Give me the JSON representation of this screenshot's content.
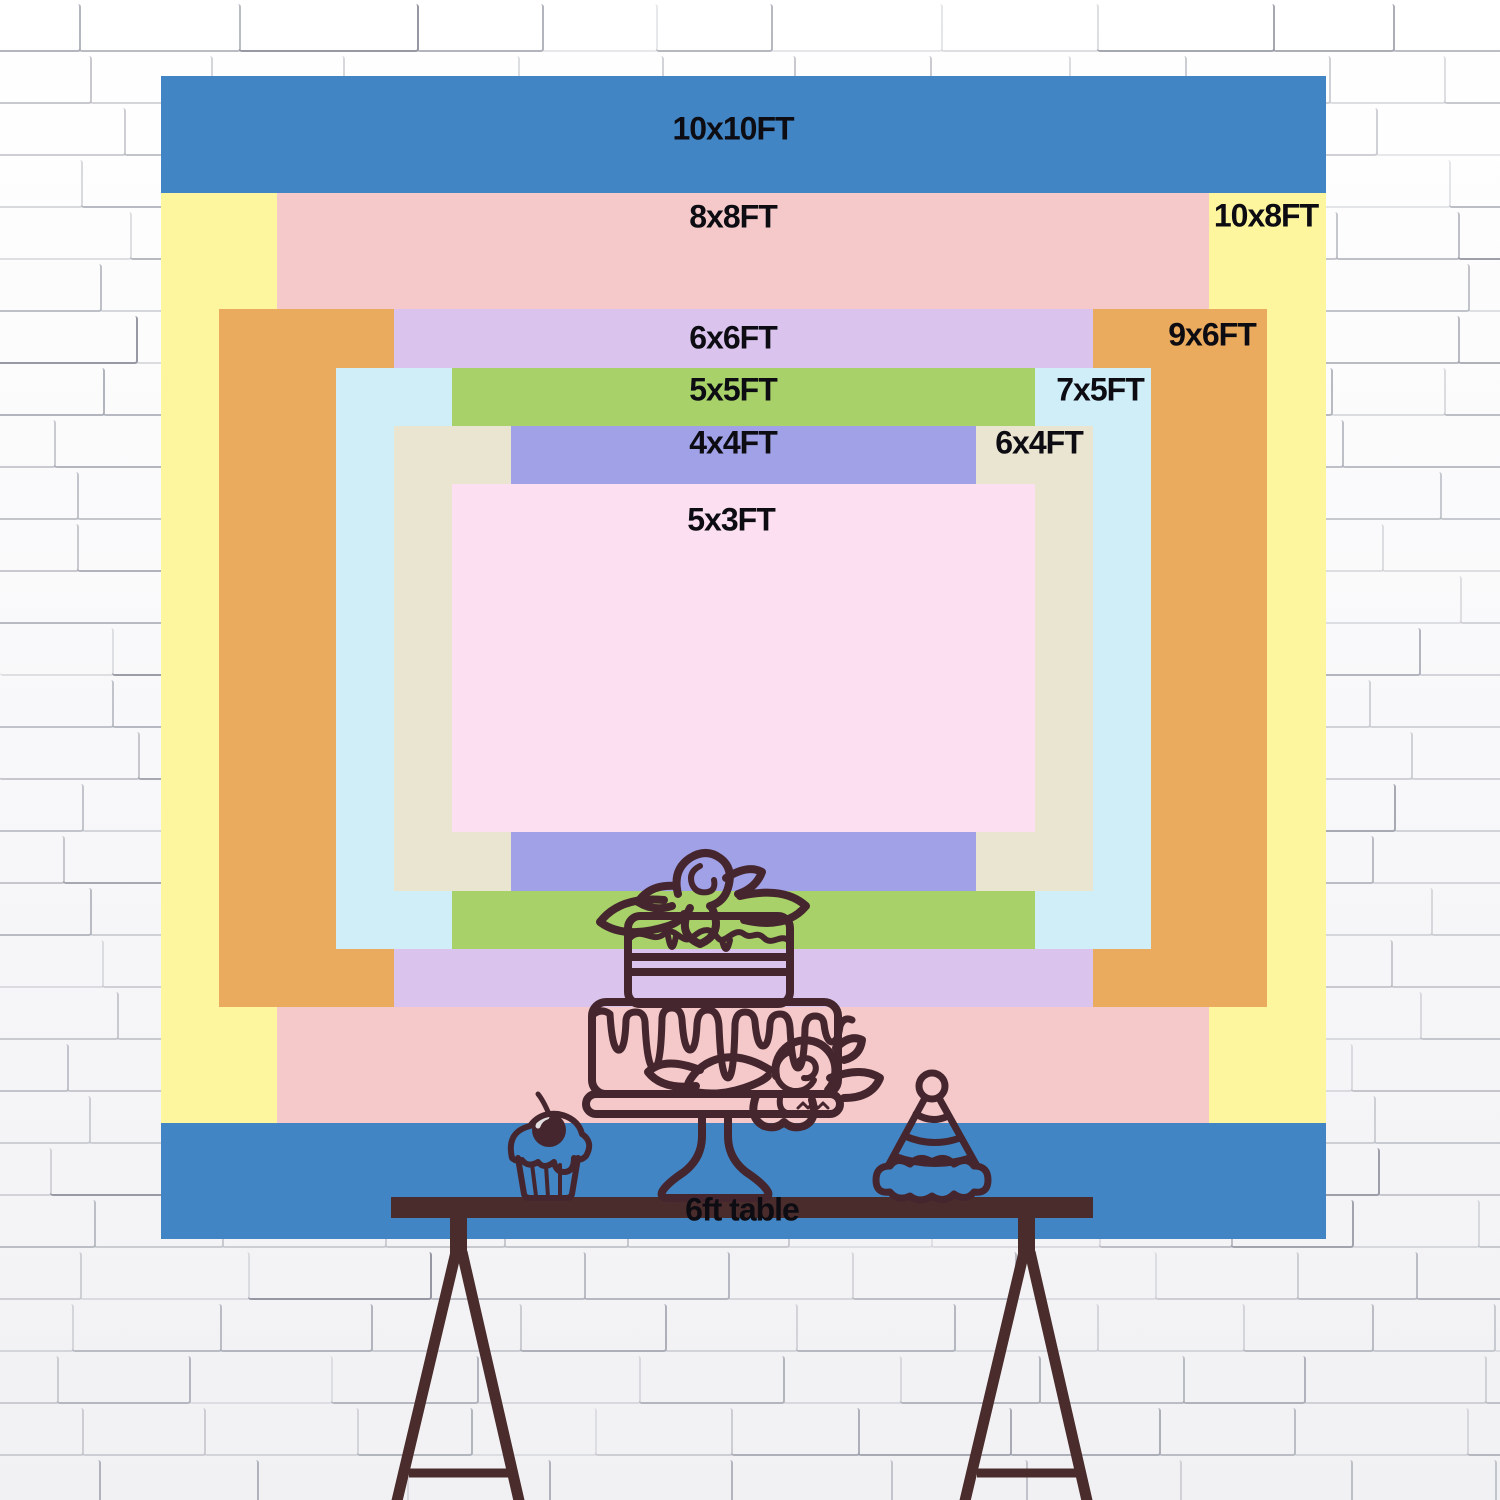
{
  "backdrop": {
    "description": "backdrop size comparison chart",
    "sizes": [
      {
        "label": "10x10FT",
        "width_ft": 10,
        "height_ft": 10,
        "color": "#4285c5"
      },
      {
        "label": "10x8FT",
        "width_ft": 10,
        "height_ft": 8,
        "color": "#fdf69e"
      },
      {
        "label": "8x8FT",
        "width_ft": 8,
        "height_ft": 8,
        "color": "#f5c9c9"
      },
      {
        "label": "9x6FT",
        "width_ft": 9,
        "height_ft": 6,
        "color": "#ebab5e"
      },
      {
        "label": "6x6FT",
        "width_ft": 6,
        "height_ft": 6,
        "color": "#dac4ee"
      },
      {
        "label": "7x5FT",
        "width_ft": 7,
        "height_ft": 5,
        "color": "#cfeef8"
      },
      {
        "label": "5x5FT",
        "width_ft": 5,
        "height_ft": 5,
        "color": "#a8d169"
      },
      {
        "label": "6x4FT",
        "width_ft": 6,
        "height_ft": 4,
        "color": "#eae5d1"
      },
      {
        "label": "4x4FT",
        "width_ft": 4,
        "height_ft": 4,
        "color": "#a1a1e7"
      },
      {
        "label": "5x3FT",
        "width_ft": 5,
        "height_ft": 3,
        "color": "#fcdff0"
      }
    ]
  },
  "table": {
    "label": "6ft table"
  },
  "decorations": [
    "tiered-cake",
    "cupcake-with-cherry",
    "party-hat"
  ],
  "colors": {
    "text": "#0c0c12",
    "line_art": "#45262e",
    "table": "#4a2c2c",
    "wall_mortar": "#868b97"
  }
}
